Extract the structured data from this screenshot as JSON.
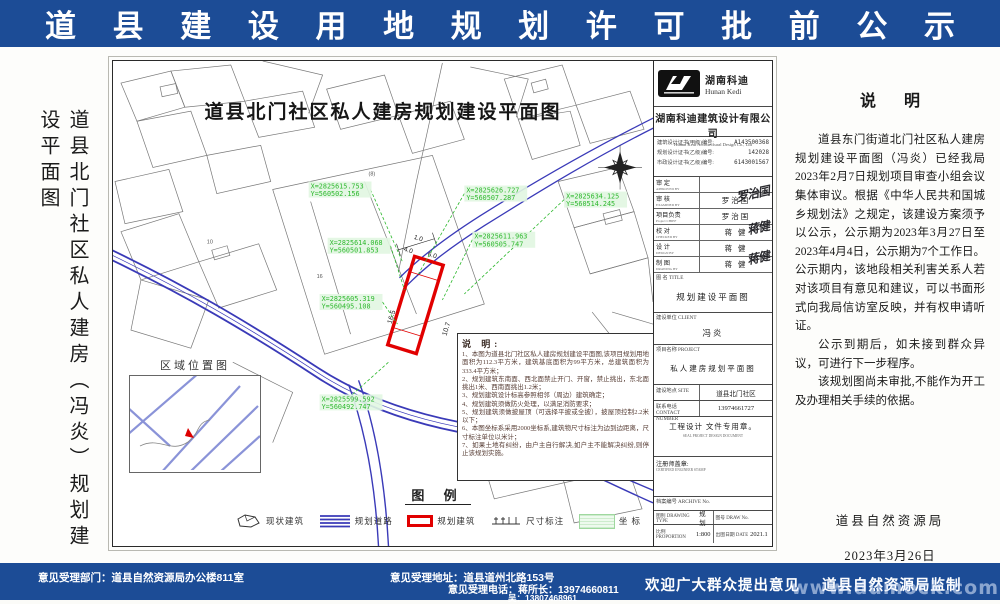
{
  "header": {
    "title": "道 县 建 设 用 地 规 划 许 可 批 前 公 示"
  },
  "left_title": "道县北门社区私人建房（冯炎）规划建设平面图",
  "map": {
    "title": "道县北门社区私人建房规划建设平面图",
    "inset_label": "区域位置图",
    "parcel_labels": [
      "(8)",
      "10",
      "16",
      "44"
    ],
    "dims": {
      "d1": "16.5",
      "d2": "10.7",
      "d3": "4.0",
      "d4": "6.0",
      "d5": "1.0"
    },
    "coords": [
      {
        "x": "X=2825615.753",
        "y": "Y=560502.156"
      },
      {
        "x": "X=2825626.727",
        "y": "Y=560507.287"
      },
      {
        "x": "X=2825634.125",
        "y": "Y=560514.245"
      },
      {
        "x": "X=2825614.068",
        "y": "Y=560501.853"
      },
      {
        "x": "X=2825611.963",
        "y": "Y=560505.747"
      },
      {
        "x": "X=2825605.319",
        "y": "Y=560495.108"
      },
      {
        "x": "X=2825599.592",
        "y": "Y=560492.747"
      },
      {
        "x": "X=2825592.156",
        "y": "Y=560486.497"
      }
    ],
    "notes_title": "说 明:",
    "notes": [
      "1、本图为道县北门社区私人建房规划建设平面图,该项目规划用地面积为112.3平方米，建筑基底面积为99平方米，总建筑面积为333.4平方米；",
      "2、规划建筑东南面、西北面禁止开门、开窗，禁止挑出，东北面挑出1米、西南面挑出1.2米；",
      "3、规划建筑设计标高参照相邻（周边）建筑确定；",
      "4、规划建筑须做防火处理，以满足消防要求；",
      "5、规划建筑须做披屋顶（可选择平披或全披），披屋顶控制2.2米以下；",
      "6、本图坐标系采用2000坐标系,建筑物尺寸标注为边到边距离，尺寸标注单位以米计；",
      "7、如果土地有纠纷，由户主自行解决,如户主不能解决纠纷,则停止该规划实施。"
    ],
    "legend": {
      "title": "图  例",
      "items": [
        {
          "label": "现状建筑"
        },
        {
          "label": "规划道路"
        },
        {
          "label": "规划建筑"
        },
        {
          "label": "尺寸标注"
        },
        {
          "label": "坐  标"
        }
      ]
    }
  },
  "title_block": {
    "brand_cn": "湖南科迪",
    "brand_en": "Hunan Kedi",
    "company_cn": "湖南科迪建筑设计有限公司",
    "company_en": "Hunan Kedi Architectural Design Co., Ltd",
    "certs": [
      {
        "label": "建筑设计证书(甲级)编号:",
        "value": "A143500368"
      },
      {
        "label": "规划设计证书(乙级)编号:",
        "value": "142028"
      },
      {
        "label": "市政设计证书(乙级)编号:",
        "value": "6143001567"
      }
    ],
    "staff": [
      {
        "role": "审  定",
        "en": "APPROVED BY",
        "name": ""
      },
      {
        "role": "审  核",
        "en": "EXAMINED BY",
        "name": "罗治国",
        "sig": "罗治国"
      },
      {
        "role": "项目负责",
        "en": "Project CHIEF",
        "name": "罗治国"
      },
      {
        "role": "校  对",
        "en": "CHECKED BY",
        "name": "蒋 健",
        "sig": "蒋健"
      },
      {
        "role": "设  计",
        "en": "DESIGN BY",
        "name": "蒋 健"
      },
      {
        "role": "制  图",
        "en": "DRAWING BY",
        "name": "蒋 健",
        "sig": "蒋健"
      }
    ],
    "drawing_title_label": "图 名 TITLE",
    "drawing_title": "规划建设平面图",
    "client_label": "建设单位 CLIENT",
    "client": "冯炎",
    "project_label": "项目名称 PROJECT",
    "project": "私人建房规划平面图",
    "site_label": "建设地点 SITE",
    "site": "道县北门社区",
    "phone_label": "联系电话 CONTACT NUMBER",
    "phone": "13974661727",
    "seal_note": "工程设计 文件专用章。",
    "seal_note_en": "SEAL PROJECT DESIGN DOCUMENT",
    "stamp_label": "注册师盖章:",
    "stamp_en": "CERTIFIED ENGINEER STAMP",
    "archive_label": "档案编号 ARCHIVE No.",
    "type_label": "图别 DRAWING TYPE",
    "type_value": "规划",
    "no_label": "图号 DRAW No.",
    "no_value": "",
    "scale_label": "比例 PROPORTION",
    "scale_value": "1:800",
    "date_label": "出图日期 DATE",
    "date_value": "2021.1"
  },
  "statement": {
    "heading": "说    明",
    "paragraphs": [
      "道县东门街道北门社区私人建房规划建设平面图（冯炎）已经我局2023年2月7日规划项目审查小组会议集体审议。根据《中华人民共和国城乡规划法》之规定，该建设方案须予以公示，公示期为2023年3月27日至2023年4月4日，公示期为7个工作日。公示期内，该地段相关利害关系人若对该项目有意见和建议，可以书面形式向我局信访室反映，并有权申请听证。",
      "公示到期后，如未接到群众异议，可进行下一步程序。",
      "该规划图尚未审批,不能作为开工及办理相关手续的依据。"
    ],
    "sign_org": "道县自然资源局",
    "sign_date": "2023年3月26日"
  },
  "footer": {
    "dept": "意见受理部门：道县自然资源局办公楼811室",
    "address": "意见受理地址：道县道州北路153号",
    "phone": "意见受理电话：蒋所长：13974660811",
    "phone2": "吴：13807468961",
    "welcome": "欢迎广大群众提出意见",
    "producer": "道县自然资源局监制",
    "watermark": "www.dumock.com"
  },
  "colors": {
    "banner_blue": "#1c4c96",
    "plot_red": "#e10000",
    "road_blue": "#3a3ab8",
    "coord_green": "#2db82d"
  }
}
